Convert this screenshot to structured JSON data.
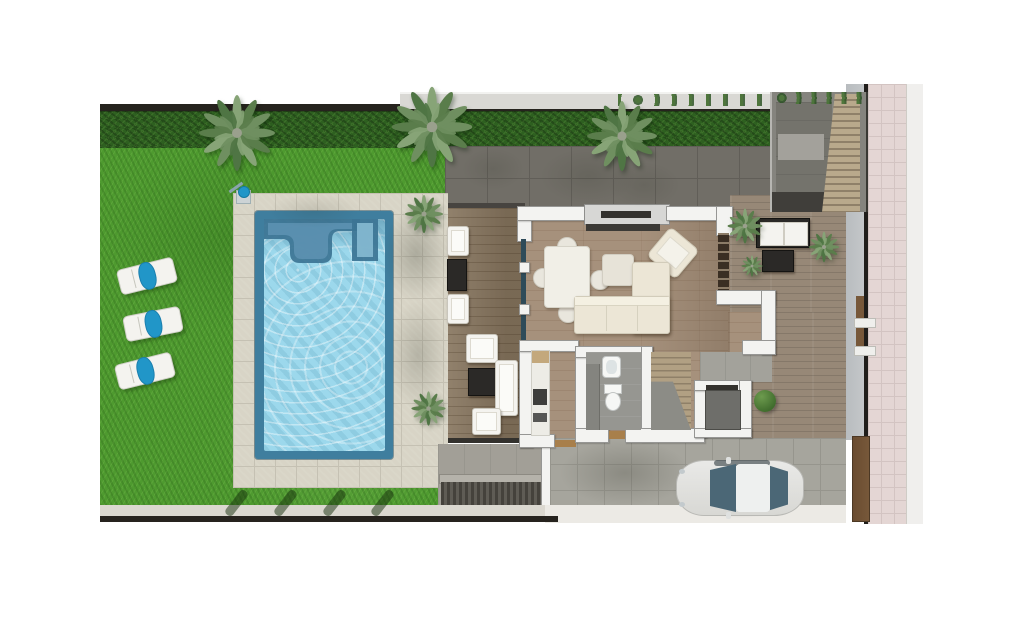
{
  "scene": {
    "kind": "architectural-top-view-rendering",
    "contains": [
      "garden-lawn",
      "swimming-pool",
      "pool-terrace",
      "outdoor-shower",
      "sun-loungers",
      "palm-trees",
      "villa-floor-plan",
      "covered-deck",
      "living-dining-room",
      "kitchen",
      "bathroom",
      "interior-stairs",
      "storage-room",
      "side-patio",
      "exterior-stairwell",
      "driveway",
      "parked-car",
      "basement-ramp",
      "pink-sidewalk",
      "perimeter-hedge",
      "perimeter-fence"
    ]
  },
  "colors": {
    "page_bg": "#ffffff",
    "lawn": "#4e9a2f",
    "hedge": "#2e6020",
    "fence_dark": "#26231e",
    "neighbor_wall": "#d9d8d4",
    "walkway": "#716e67",
    "walkway_line": "#615e58",
    "gravel": "#c7b08a",
    "paving": "#d8d4c6",
    "paving_line": "#c5c1b3",
    "pool_edge": "#3f7e9e",
    "pool_water": "#9cd8ec",
    "deck": "#8a7963",
    "floor": "#a6917c",
    "hall_gray": "#a3a29b",
    "patio": "#978877",
    "wall": "#f3f3f1",
    "wall_border": "#969694",
    "window_frame": "#d7d7d5",
    "slot_dark": "#34322e",
    "glass": "#2e4b59",
    "counter_white": "#edece6",
    "appliance": "#3e3e3c",
    "board_tan": "#c3a87c",
    "bath_floor": "#969691",
    "vanity": "#84847f",
    "fixture_white": "#f6f7f5",
    "stairs_wood": "#b1a083",
    "stairs_wood_dark": "#8f8068",
    "landing": "#8c8c86",
    "storage_floor": "#6e6e6a",
    "shelf_dark": "#3a2e23",
    "mat": "#a87f4b",
    "sofa": "#ece6d6",
    "sofa_border": "#d2ccba",
    "table_white": "#f1efe7",
    "chair": "#e9e6dd",
    "pouf": "#e7e3d8",
    "dark_furn": "#2b2927",
    "cushion_white": "#f4f3ef",
    "drive": "#a6a59d",
    "drive_line": "#96958d",
    "ramp_dark": "#45423c",
    "ramp_mid": "#5f5c55",
    "ramp_wall": "#b5b2aa",
    "curb": "#dbd8d0",
    "bottom_white": "#eceae5",
    "sidewalk": "#e4d6d4",
    "sidewalk_line": "#d3c4c2",
    "curb_white": "#f0efed",
    "wedge_gray": "#c5c8ca",
    "gate_brown": "#77583a",
    "car_body": "#e9e9e7",
    "car_glass": "#4b6776",
    "towel": "#2196c8"
  },
  "garden": {
    "trees": [
      {
        "x": 237,
        "y": 133,
        "s": 1.0
      },
      {
        "x": 432,
        "y": 127,
        "s": 1.06
      },
      {
        "x": 622,
        "y": 136,
        "s": 0.92
      },
      {
        "x": 424,
        "y": 214,
        "s": 0.5
      },
      {
        "x": 428,
        "y": 408,
        "s": 0.45
      },
      {
        "x": 745,
        "y": 226,
        "s": 0.46
      },
      {
        "x": 824,
        "y": 247,
        "s": 0.4
      },
      {
        "x": 752,
        "y": 266,
        "s": 0.28
      }
    ],
    "loungers": [
      {
        "x": 118,
        "y": 263,
        "rot": -14
      },
      {
        "x": 124,
        "y": 311,
        "rot": -11
      },
      {
        "x": 116,
        "y": 358,
        "rot": -14
      }
    ],
    "post_shadows": [
      {
        "x": 232,
        "y": 488
      },
      {
        "x": 281,
        "y": 488
      },
      {
        "x": 330,
        "y": 488
      },
      {
        "x": 378,
        "y": 488
      }
    ],
    "shade_blobs": [
      {
        "x": 383,
        "y": 206,
        "w": 66,
        "h": 96,
        "a": 0.25
      },
      {
        "x": 388,
        "y": 300,
        "w": 60,
        "h": 110,
        "a": 0.2
      },
      {
        "x": 268,
        "y": 194,
        "w": 92,
        "h": 34,
        "a": 0.12
      },
      {
        "x": 540,
        "y": 148,
        "w": 96,
        "h": 56,
        "a": 0.14
      },
      {
        "x": 608,
        "y": 162,
        "w": 72,
        "h": 46,
        "a": 0.12
      },
      {
        "x": 462,
        "y": 148,
        "w": 62,
        "h": 42,
        "a": 0.12
      }
    ]
  }
}
